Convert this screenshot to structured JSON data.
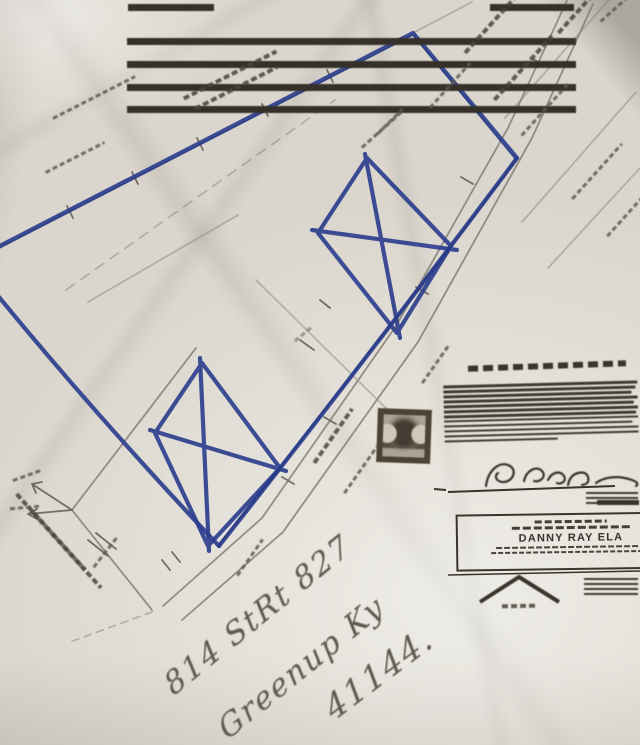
{
  "colors": {
    "paper": "#dad6cd",
    "pen_blue": "#2e3f8e",
    "pen_blue_deep": "#1d2f7a",
    "pencil": "#857f72",
    "graphite": "#5f594d",
    "ink": "#38342c"
  },
  "handwriting": {
    "address_line1": "814 StRt 827",
    "address_line2": "Greenup Ky",
    "address_line3": "41144."
  },
  "title_block": {
    "owner_name": "DANNY RAY ELA"
  },
  "counts": {
    "barcode_full_rows": 4,
    "cert_text_rows": 12,
    "sig_side_rows": 3,
    "logo_side_rows": 4
  }
}
